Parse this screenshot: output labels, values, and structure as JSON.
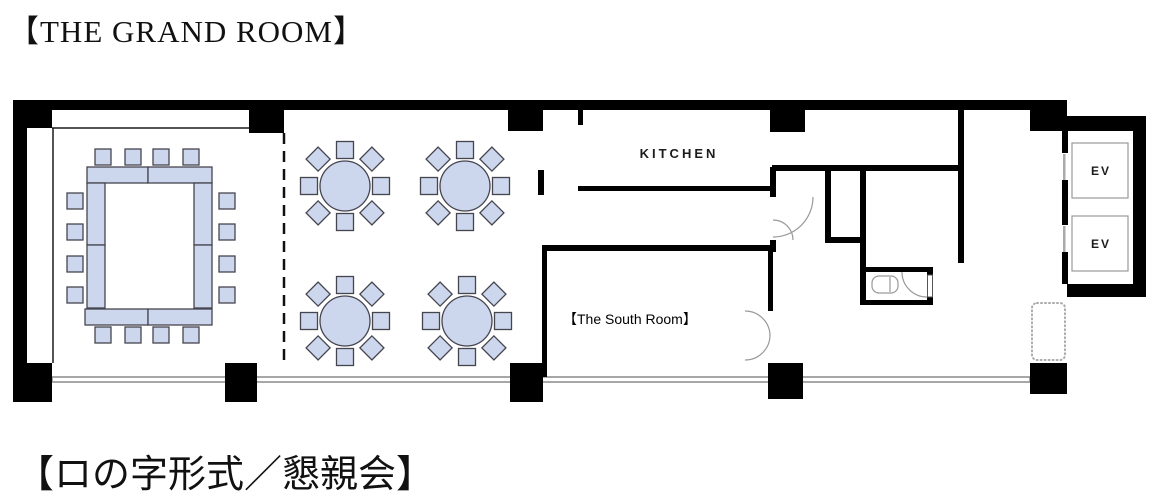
{
  "page": {
    "title": "【THE GRAND ROOM】",
    "caption": "【ロの字形式／懇親会】"
  },
  "floor_plan": {
    "labels": {
      "kitchen": "KITCHEN",
      "south_room": "【The South Room】",
      "elevator_top": "EV",
      "elevator_bottom": "EV"
    },
    "colors": {
      "wall": "#000000",
      "furniture_fill": "#ccd6ec",
      "furniture_stroke": "#45454f",
      "door_arc": "#9a9a9a",
      "window": "#8a8a8a"
    },
    "furniture": {
      "hollow_square_seating": {
        "chairs": 16,
        "chairs_per_side": 4
      },
      "round_tables": {
        "count": 4,
        "chairs_each": 8
      }
    }
  }
}
